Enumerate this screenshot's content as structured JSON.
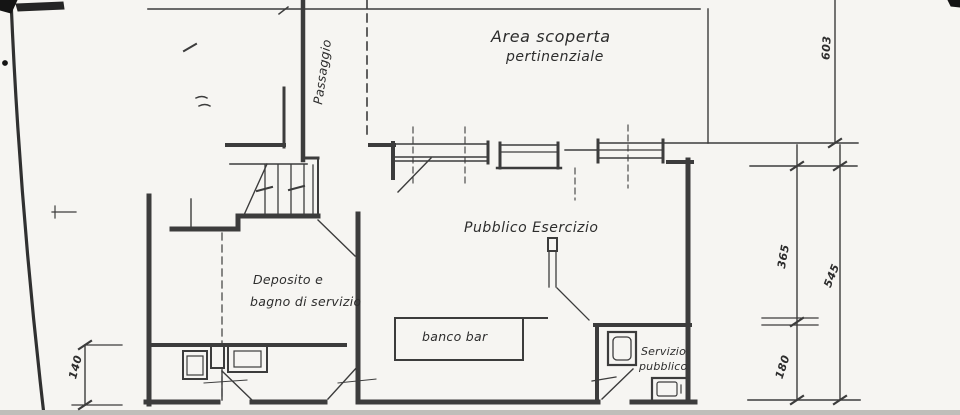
{
  "labels": {
    "passaggio": "Passaggio",
    "area_scoperta_line1": "Area scoperta",
    "area_scoperta_line2": "pertinenziale",
    "pubblico_esercizio": "Pubblico Esercizio",
    "deposito_line1": "Deposito e",
    "deposito_line2": "bagno di servizio",
    "banco_bar": "banco bar",
    "servizio_line1": "Servizio",
    "servizio_line2": "pubblico"
  },
  "dimensions": {
    "courtyard_height": "603",
    "upper_room_height": "365",
    "total_right_height": "545",
    "lower_room_height": "180",
    "left_height": "140"
  },
  "colors": {
    "ink": "#3c3c3c",
    "paper": "#f6f5f2",
    "scan_edge": "#141414",
    "shadow_band": "#bfbeba"
  }
}
